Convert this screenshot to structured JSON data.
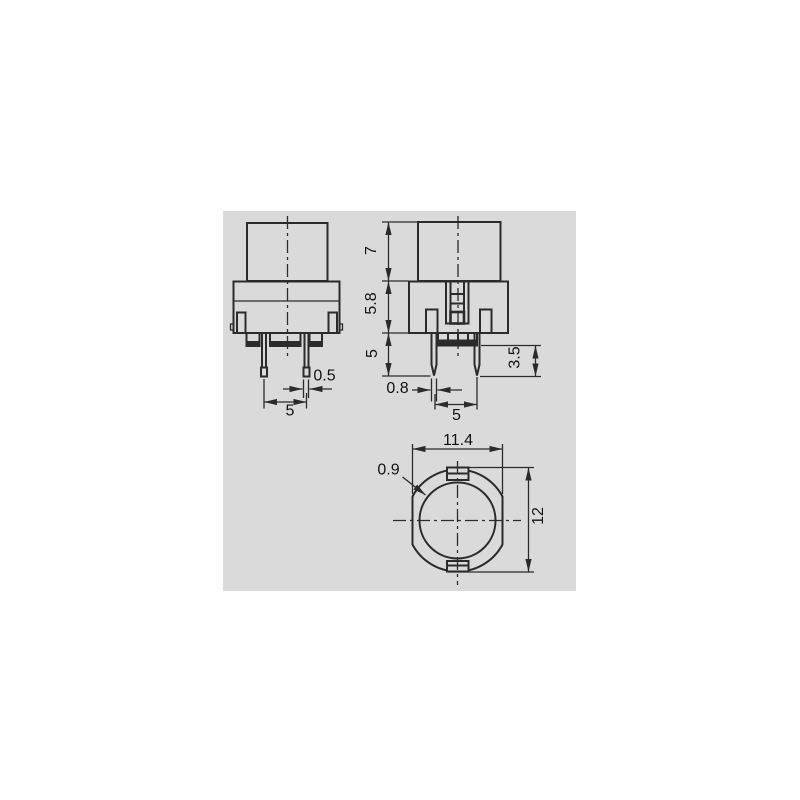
{
  "views": {
    "front": {
      "dims": {
        "pin_width": "0.5",
        "pin_spacing": "5"
      }
    },
    "side": {
      "dims": {
        "cap_height": "7",
        "body_height": "5.8",
        "pin_length": "5",
        "pin_width": "0.8",
        "pin_spacing": "5",
        "pin_tip_length": "3.5"
      }
    },
    "bottom": {
      "dims": {
        "width_across_flats": "11.4",
        "rim_width": "0.9",
        "outer_diameter": "12"
      }
    }
  },
  "colors": {
    "page": "#ffffff",
    "panel": "#dadada",
    "line": "#2b2b2b",
    "text": "#111111"
  }
}
